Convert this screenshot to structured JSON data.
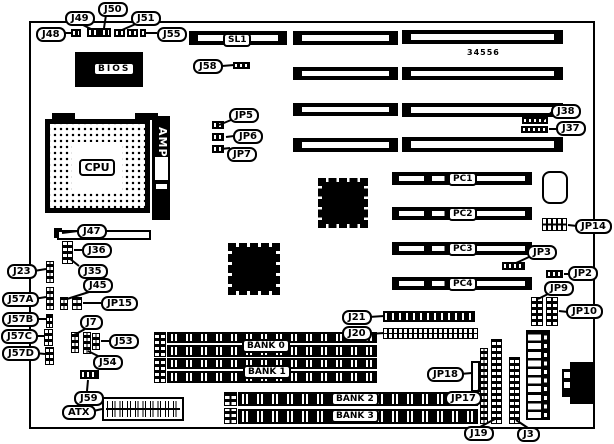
{
  "board": {
    "part_number": "34556"
  },
  "chips": {
    "bios": "BIOS",
    "cpu": "CPU",
    "amp": "AMP"
  },
  "slots": {
    "sl1": "SL1",
    "pci": {
      "pc1": "PC1",
      "pc2": "PC2",
      "pc3": "PC3",
      "pc4": "PC4"
    },
    "banks": {
      "bank0": "BANK 0",
      "bank1": "BANK 1",
      "bank2": "BANK 2",
      "bank3": "BANK 3"
    }
  },
  "callouts": {
    "j48": "J48",
    "j49": "J49",
    "j50": "J50",
    "j51": "J51",
    "j55": "J55",
    "j58": "J58",
    "jp5": "JP5",
    "jp6": "JP6",
    "jp7": "JP7",
    "j38": "J38",
    "j37": "J37",
    "jp14": "JP14",
    "jp3": "JP3",
    "jp2": "JP2",
    "jp9": "JP9",
    "jp10": "JP10",
    "j23": "J23",
    "j57a": "J57A",
    "j57b": "J57B",
    "j57c": "J57C",
    "j57d": "J57D",
    "j47": "J47",
    "j36": "J36",
    "j35": "J35",
    "j45": "J45",
    "jp15": "JP15",
    "j7": "J7",
    "j53": "J53",
    "j54": "J54",
    "j59": "J59",
    "atx": "ATX",
    "j21": "J21",
    "j20": "J20",
    "jp18": "JP18",
    "jp17": "JP17",
    "j19": "J19",
    "j3": "J3"
  },
  "colors": {
    "line": "#000000",
    "background": "#ffffff"
  }
}
